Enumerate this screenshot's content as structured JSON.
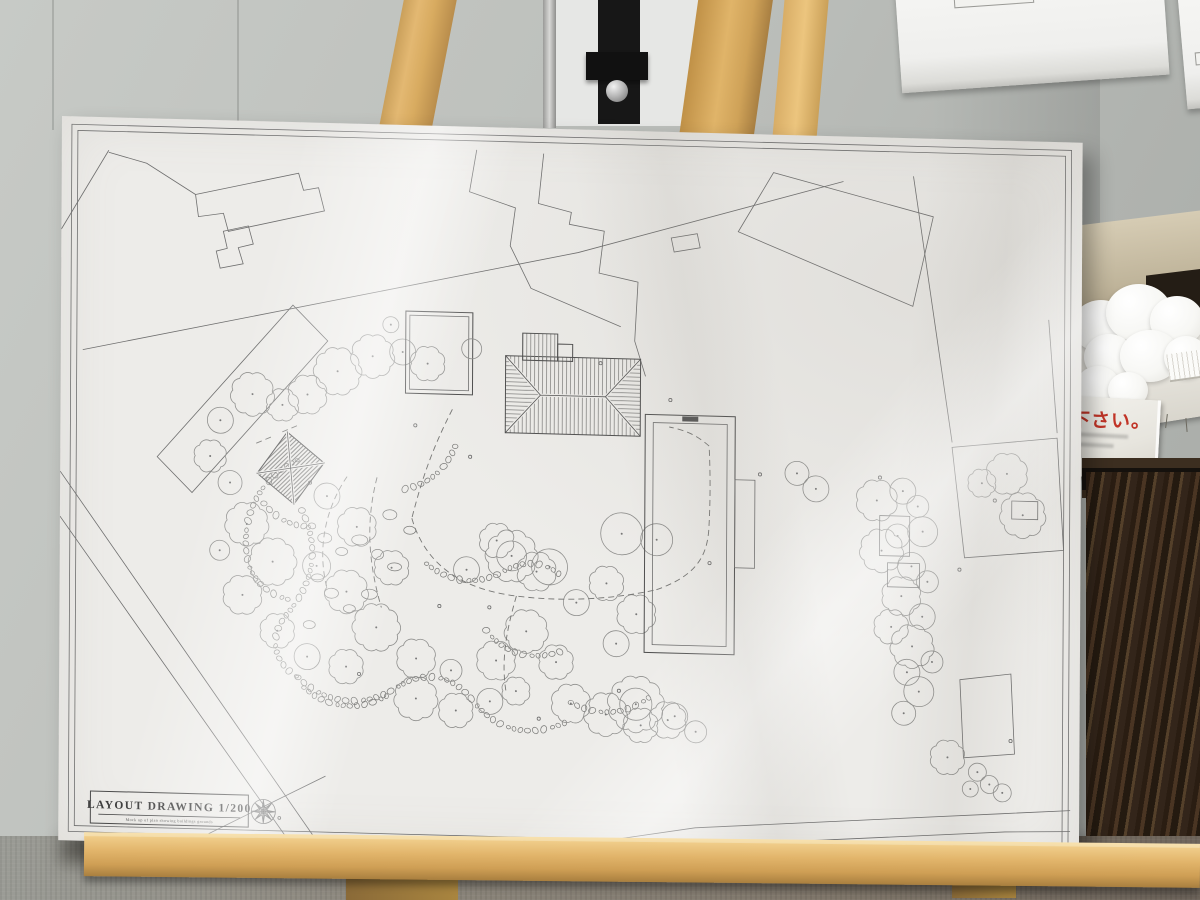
{
  "board": {
    "title_block": {
      "title": "LAYOUT DRAWING 1/200",
      "subtitle": "Mock up of plan showing buildings grounds"
    }
  },
  "signs": {
    "card_text": "下さい。"
  },
  "colors": {
    "accent_red": "#c13427",
    "plan_line": "#6e6e6e",
    "board_white": "#edece9",
    "wall_gray": "#bcbfbb",
    "easel_wood": "#d8ab60",
    "dark_wood": "#33251a"
  },
  "plan": {
    "border": {
      "outer": [
        10,
        8,
        1000,
        707
      ],
      "inner": [
        16,
        14,
        988,
        695
      ]
    },
    "outlines": [
      {
        "pts": "134,75 237,51 242,68 257,65 263,88 167,111 162,93 137,97",
        "closed": true
      },
      {
        "pts": "162,111 187,105 192,123 177,127 182,143 159,148 155,131 166,128",
        "closed": true
      },
      {
        "pts": "415,23 408,65 454,80 449,118 470,160 560,196",
        "closed": false
      },
      {
        "pts": "482,25 477,75 510,83 508,95 543,101 538,143 577,151 574,210 585,245",
        "closed": false
      },
      {
        "pts": "677,98 712,38 872,78 852,168",
        "closed": true
      },
      {
        "pts": "610,106 636,101 639,115 613,120",
        "closed": true
      },
      {
        "pts": "22,233 517,123 782,45",
        "closed": false
      },
      {
        "pts": "852,38 892,303",
        "closed": false
      },
      {
        "pts": "988,178 997,291",
        "closed": false
      },
      {
        "pts": "97,338 232,183 267,218 132,373",
        "closed": true
      },
      {
        "pts": "0,355 285,755",
        "closed": false
      },
      {
        "pts": "0,400 262,762",
        "closed": false
      },
      {
        "pts": "285,755 637,695 942,673 1012,668",
        "closed": false
      },
      {
        "pts": "297,763 637,713 947,691 1012,689",
        "closed": false
      },
      {
        "pts": "892,308 997,296 1004,408 905,418",
        "closed": true
      },
      {
        "pts": "901,540 952,533 956,613 905,618",
        "closed": true
      },
      {
        "pts": "142,718 267,653",
        "closed": false
      },
      {
        "pts": "47,33 0,113",
        "closed": false
      },
      {
        "pts": "134,75 85,45 47,35",
        "closed": false
      }
    ],
    "buildings": {
      "roof": {
        "x": 445,
        "y": 228,
        "w": 135,
        "h": 77,
        "ax": 480,
        "bx": 545,
        "proj": [
          462,
          205,
          35,
          27
        ],
        "proj2": [
          497,
          215,
          15,
          17
        ]
      },
      "square": {
        "o": [
          345,
          186,
          67,
          82
        ],
        "i": [
          349,
          190,
          59,
          74
        ],
        "circle": [
          411,
          222,
          10
        ]
      },
      "long": {
        "o": [
          585,
          283,
          90,
          238
        ],
        "i": [
          593,
          291,
          74,
          222
        ],
        "bump": [
          675,
          346,
          20,
          88
        ],
        "tick": [
          622,
          284,
          16,
          5
        ]
      },
      "pavilion": {
        "pts": "227,310 264,340 234,382 197,352"
      }
    },
    "trees": [
      [
        192,
        273,
        20,
        "s"
      ],
      [
        222,
        283,
        15,
        "s"
      ],
      [
        247,
        272,
        18,
        "s"
      ],
      [
        277,
        248,
        22,
        "s"
      ],
      [
        312,
        232,
        20,
        "s"
      ],
      [
        342,
        227,
        13,
        "c"
      ],
      [
        367,
        238,
        16,
        "s"
      ],
      [
        160,
        300,
        13,
        "c"
      ],
      [
        150,
        336,
        15,
        "s"
      ],
      [
        170,
        362,
        12,
        "c"
      ],
      [
        187,
        403,
        20,
        "s"
      ],
      [
        213,
        440,
        22,
        "s"
      ],
      [
        183,
        474,
        18,
        "s"
      ],
      [
        218,
        509,
        16,
        "s"
      ],
      [
        160,
        430,
        10,
        "c"
      ],
      [
        267,
        373,
        13,
        "c"
      ],
      [
        297,
        403,
        18,
        "s"
      ],
      [
        332,
        443,
        16,
        "s"
      ],
      [
        287,
        468,
        20,
        "s"
      ],
      [
        257,
        443,
        14,
        "c"
      ],
      [
        317,
        503,
        22,
        "s"
      ],
      [
        357,
        533,
        18,
        "s"
      ],
      [
        287,
        543,
        16,
        "s"
      ],
      [
        248,
        534,
        13,
        "c"
      ],
      [
        357,
        573,
        20,
        "s"
      ],
      [
        397,
        584,
        16,
        "s"
      ],
      [
        431,
        574,
        13,
        "c"
      ],
      [
        392,
        544,
        11,
        "c"
      ],
      [
        437,
        533,
        18,
        "s"
      ],
      [
        467,
        503,
        20,
        "s"
      ],
      [
        497,
        533,
        16,
        "s"
      ],
      [
        457,
        563,
        13,
        "s"
      ],
      [
        512,
        574,
        18,
        "s"
      ],
      [
        547,
        584,
        20,
        "s"
      ],
      [
        582,
        594,
        16,
        "s"
      ],
      [
        616,
        584,
        13,
        "c"
      ],
      [
        407,
        443,
        13,
        "c"
      ],
      [
        437,
        413,
        16,
        "s"
      ],
      [
        477,
        443,
        18,
        "s"
      ],
      [
        517,
        473,
        13,
        "c"
      ],
      [
        547,
        453,
        16,
        "s"
      ],
      [
        577,
        483,
        18,
        "s"
      ],
      [
        557,
        513,
        13,
        "c"
      ],
      [
        452,
        428,
        24,
        "s"
      ],
      [
        490,
        438,
        18,
        "c"
      ],
      [
        562,
        403,
        21,
        "c"
      ],
      [
        597,
        408,
        16,
        "c"
      ],
      [
        577,
        573,
        26,
        "s"
      ],
      [
        609,
        588,
        17,
        "s"
      ],
      [
        637,
        599,
        11,
        "c"
      ],
      [
        737,
        338,
        12,
        "c"
      ],
      [
        756,
        353,
        13,
        "c"
      ],
      [
        817,
        363,
        19,
        "s"
      ],
      [
        843,
        353,
        13,
        "c"
      ],
      [
        858,
        368,
        11,
        "c"
      ],
      [
        863,
        393,
        15,
        "c"
      ],
      [
        838,
        398,
        12,
        "c"
      ],
      [
        822,
        413,
        20,
        "s"
      ],
      [
        852,
        428,
        14,
        "c"
      ],
      [
        868,
        443,
        11,
        "c"
      ],
      [
        842,
        458,
        18,
        "s"
      ],
      [
        863,
        478,
        13,
        "c"
      ],
      [
        832,
        489,
        16,
        "s"
      ],
      [
        853,
        508,
        20,
        "s"
      ],
      [
        873,
        523,
        11,
        "c"
      ],
      [
        848,
        534,
        13,
        "c"
      ],
      [
        860,
        553,
        15,
        "c"
      ],
      [
        845,
        575,
        12,
        "c"
      ],
      [
        922,
        343,
        13,
        "s"
      ],
      [
        947,
        333,
        19,
        "s"
      ],
      [
        963,
        374,
        21,
        "s"
      ],
      [
        889,
        618,
        16,
        "s"
      ],
      [
        919,
        632,
        9,
        "c"
      ],
      [
        931,
        644,
        9,
        "c"
      ],
      [
        944,
        652,
        9,
        "c"
      ],
      [
        912,
        649,
        8,
        "c"
      ],
      [
        330,
        200,
        8,
        "c"
      ]
    ],
    "tree_rects": [
      [
        820,
        378,
        30,
        40
      ],
      [
        828,
        425,
        32,
        24
      ],
      [
        952,
        360,
        26,
        18
      ]
    ],
    "stones": [
      "M 237,338 c -40,20 -55,60 -50,95 c 3,25 20,40 45,45",
      "M 242,388 c 20,40 10,75 -15,105 c -18,22 -13,48 12,62",
      "M 239,555 c 30,28 68,28 98,8 c 30,-20 58,-14 78,12 c 25,30 58,34 92,18",
      "M 512,573 c 30,15 58,10 82,-10",
      "M 367,438 c 25,20 53,20 78,5 c 20,-12 43,-10 58,5",
      "M 427,503 c 20,25 48,30 78,18",
      "M 204,382 c 15,18 35,25 55,20",
      "M 395,320 c -10,25 -28,40 -55,45",
      "M 245,565 c 25,22 58,22 85,5"
    ],
    "dashes": [
      "M 392,283 C 372,323 362,353 352,393",
      "M 352,393 C 367,443 407,463 457,468 C 507,473 557,468 597,458",
      "M 597,458 C 637,443 647,423 649,398 C 651,363 650,333 649,313",
      "M 649,313 C 637,303 627,298 609,295",
      "M 287,353 C 267,383 257,423 267,463",
      "M 317,353 C 307,393 307,433 322,483",
      "M 457,468 C 447,503 442,533 447,563",
      "M 196,322 l 18,-8 m 8,-4 l 18,-8"
    ],
    "rocks": [
      [
        265,
        415,
        7,
        5
      ],
      [
        282,
        428,
        6,
        4
      ],
      [
        300,
        416,
        8,
        5
      ],
      [
        318,
        430,
        6,
        5
      ],
      [
        335,
        442,
        7,
        4
      ],
      [
        258,
        455,
        6,
        4
      ],
      [
        272,
        470,
        7,
        5
      ],
      [
        290,
        485,
        6,
        4
      ],
      [
        310,
        470,
        8,
        5
      ],
      [
        250,
        502,
        6,
        4
      ],
      [
        330,
        390,
        7,
        5
      ],
      [
        350,
        405,
        6,
        4
      ]
    ],
    "dots": [
      [
        540,
        233
      ],
      [
        610,
        268
      ],
      [
        355,
        300
      ],
      [
        410,
        330
      ],
      [
        250,
        360
      ],
      [
        300,
        550
      ],
      [
        430,
        480
      ],
      [
        650,
        430
      ],
      [
        700,
        340
      ],
      [
        560,
        560
      ],
      [
        480,
        590
      ],
      [
        380,
        480
      ],
      [
        820,
        340
      ],
      [
        900,
        430
      ],
      [
        935,
        360
      ],
      [
        952,
        600
      ]
    ],
    "title_block": {
      "box": [
        32,
        674,
        158,
        32
      ],
      "underline": [
        40,
        697,
        182,
        697
      ],
      "compass": [
        205,
        690,
        12
      ]
    }
  }
}
